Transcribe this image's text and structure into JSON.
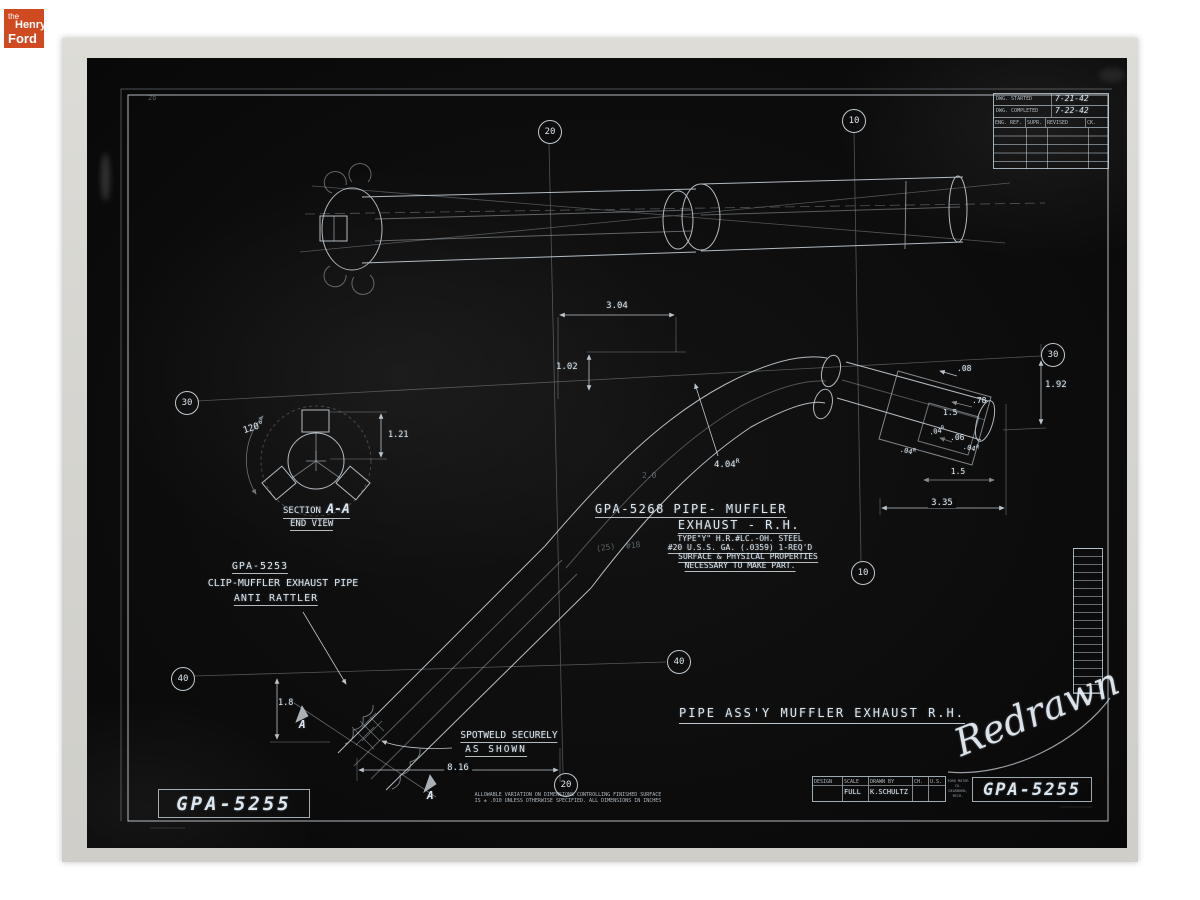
{
  "logo": {
    "the": "the",
    "henry": "Henry",
    "ford": "Ford",
    "bg": "#cf4a21"
  },
  "header_table": {
    "rows": [
      {
        "label": "DWG. STARTED",
        "value": "7-21-42"
      },
      {
        "label": "DWG. COMPLETED",
        "value": "7-22-42"
      }
    ],
    "columns": [
      "ENG. REF.",
      "SUPR.",
      "REVISED",
      "CK."
    ]
  },
  "grid_refs": {
    "top_20": "20",
    "top_10": "10",
    "left_30": "30",
    "left_40": "40",
    "mid_40": "40",
    "mid_10": "10",
    "right_30": "30",
    "bottom_20": "20"
  },
  "section_view": {
    "angle": "120°",
    "dim_height": "1.21",
    "title_prefix": "SECTION",
    "title_letters": "A-A",
    "subtitle": "END VIEW"
  },
  "clip_note": {
    "line1": "GPA-5253",
    "line2": "CLIP-MUFFLER EXHAUST PIPE",
    "line3": "ANTI RATTLER"
  },
  "part_note": {
    "line1": "GPA-5268 PIPE- MUFFLER",
    "line2": "EXHAUST - R.H.",
    "spec1": "TYPE\"Y\" H.R.#LC.-OH. STEEL",
    "spec2": "#20 U.S.S. GA. (.0359) 1-REQ'D",
    "spec3": "SURFACE & PHYSICAL PROPERTIES",
    "spec4": "NECESSARY TO MAKE PART.",
    "pencil1": "(25)",
    "pencil2": "#18"
  },
  "spotweld_note": {
    "line1": "SPOTWELD SECURELY",
    "line2": "AS SHOWN"
  },
  "dimensions": {
    "top_width": "3.04",
    "top_height": "1.02",
    "bend_radius": "4.04",
    "sup": "R",
    "faint": "2.0",
    "d08": ".08",
    "d192": "1.92",
    "d78": ".78",
    "d15a": "1.5",
    "d04": ".04",
    "d06": ".06",
    "d15b": "1.5",
    "d335": "3.35",
    "d18": "1.8",
    "d816": "8.16"
  },
  "section_markers": {
    "a1": "A",
    "a2": "A"
  },
  "main_title": "PIPE ASS'Y MUFFLER EXHAUST R.H.",
  "signature": "Redrawn",
  "title_block": {
    "headers": [
      "DESIGN",
      "SCALE",
      "DRAWN BY",
      "CH.",
      "U.S."
    ],
    "design": "",
    "scale": "FULL",
    "drawn_by": "K.SCHULTZ",
    "ch": "",
    "us": "",
    "company1": "FORD MOTOR CO.",
    "company2": "DEARBORN, MICH.",
    "part_number": "GPA-5255"
  },
  "corner_number": "GPA-5255",
  "fine_print": {
    "line1": "ALLOWABLE VARIATION ON DIMENSIONS CONTROLLING FINISHED SURFACE",
    "line2": "IS ± .010 UNLESS OTHERWISE SPECIFIED.  ALL DIMENSIONS IN INCHES"
  },
  "corner_pencil": "2b"
}
